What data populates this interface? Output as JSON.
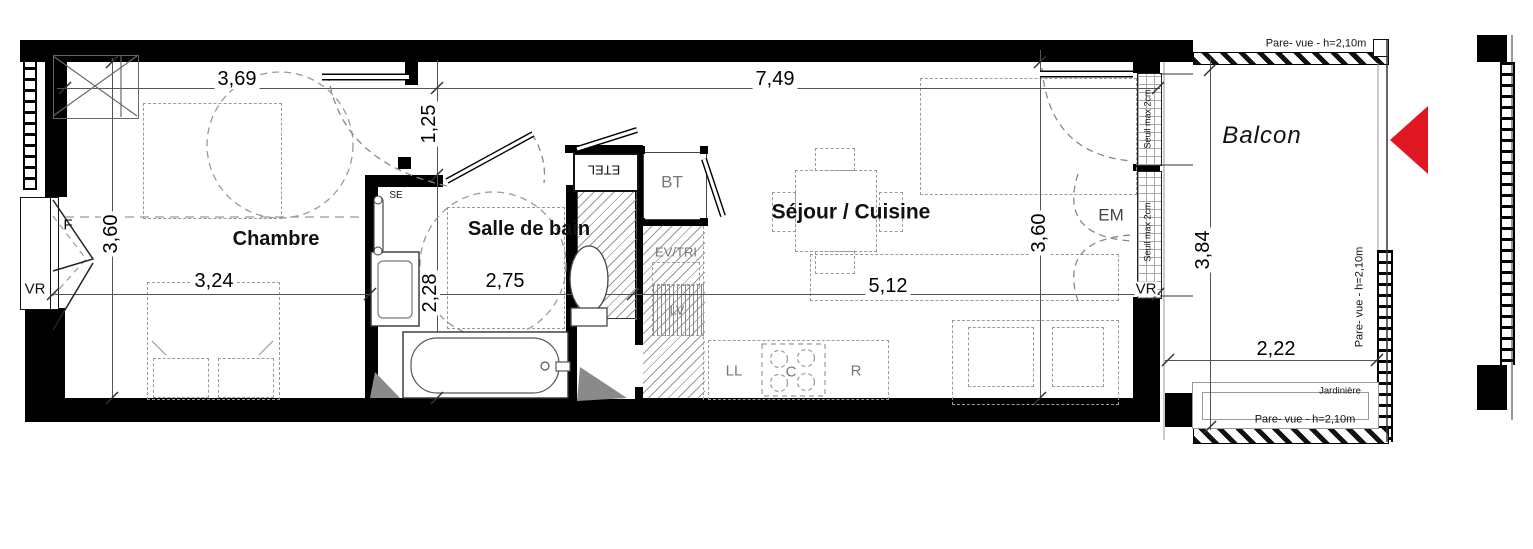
{
  "rooms": {
    "chambre": "Chambre",
    "salle_de_bain": "Salle de bain",
    "sejour_cuisine": "Séjour / Cuisine",
    "balcon": "Balcon"
  },
  "dims": {
    "d369": "3,69",
    "d749": "7,49",
    "d125": "1,25",
    "d360_left": "3,60",
    "d324": "3,24",
    "d275": "2,75",
    "d228": "2,28",
    "d512": "5,12",
    "d360_right": "3,60",
    "d384": "3,84",
    "d222": "2,22"
  },
  "fixtures": {
    "f": "F",
    "vr_left": "VR",
    "vr_right": "VR",
    "se": "SE",
    "etel": "ETEL",
    "bt": "BT",
    "ev_tri": "EV/TRI",
    "lv": "LV",
    "ll": "LL",
    "c": "C",
    "r": "R",
    "em": "EM"
  },
  "annotations": {
    "seuil_top": "Seuil max 2cm",
    "seuil_bottom": "Seuil max 2cm",
    "pare_vue_top": "Pare- vue - h=2,10m",
    "pare_vue_right": "Pare- vue - h=2,10m",
    "pare_vue_bottom": "Pare- vue - h=2,10m",
    "jardiniere": "Jardinière"
  },
  "colors": {
    "wall": "#000000",
    "furniture_dash": "#9a9a9a",
    "dimension_line": "#555555",
    "north_arrow_red": "#e01722"
  }
}
